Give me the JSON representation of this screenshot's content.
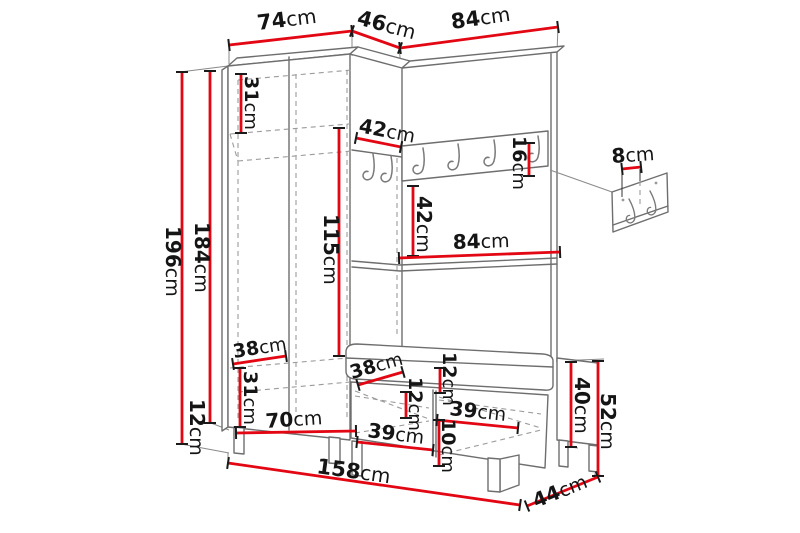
{
  "diagram": {
    "units": "cm",
    "colors": {
      "dimension_red": "#e30613",
      "furniture_gray": "#6e6e6e",
      "hidden_edge_gray": "#9b9b9b",
      "text": "#151515",
      "background": "#ffffff"
    },
    "rail_hook_count": 6,
    "wall_panel_hook_count": 2
  },
  "dimensions": [
    {
      "value": "74",
      "unit": "cm",
      "line": [
        229,
        45,
        352,
        31
      ],
      "label": [
        258,
        30,
        -7,
        21
      ]
    },
    {
      "value": "46",
      "unit": "cm",
      "line": [
        352,
        31,
        400,
        48
      ],
      "label": [
        356,
        24,
        15,
        21
      ]
    },
    {
      "value": "84",
      "unit": "cm",
      "line": [
        400,
        48,
        558,
        27
      ],
      "label": [
        452,
        29,
        -8,
        21
      ]
    },
    {
      "value": "196",
      "unit": "cm",
      "line": [
        182,
        72,
        182,
        444
      ],
      "label": [
        166,
        226,
        90,
        20
      ]
    },
    {
      "value": "184",
      "unit": "cm",
      "line": [
        210,
        71,
        210,
        423
      ],
      "label": [
        195,
        222,
        90,
        20
      ]
    },
    {
      "value": "12",
      "unit": "cm",
      "line": null,
      "label": [
        190,
        399,
        90,
        20
      ]
    },
    {
      "value": "31",
      "unit": "cm",
      "line": [
        241,
        74,
        241,
        133
      ],
      "label": [
        245,
        76,
        90,
        19
      ]
    },
    {
      "value": "115",
      "unit": "cm",
      "line": [
        339,
        128,
        339,
        356
      ],
      "label": [
        324,
        214,
        90,
        20
      ]
    },
    {
      "value": "38",
      "unit": "cm",
      "line": [
        233,
        364,
        286,
        356
      ],
      "label": [
        234,
        358,
        -9,
        19
      ]
    },
    {
      "value": "31",
      "unit": "cm",
      "line": [
        240,
        368,
        240,
        427
      ],
      "label": [
        244,
        371,
        90,
        19
      ]
    },
    {
      "value": "70",
      "unit": "cm",
      "line": [
        236,
        433,
        356,
        431
      ],
      "label": [
        266,
        428,
        -4,
        20
      ]
    },
    {
      "value": "42",
      "unit": "cm",
      "line": [
        356,
        138,
        401,
        147
      ],
      "label": [
        358,
        132,
        11,
        20
      ]
    },
    {
      "value": "16",
      "unit": "cm",
      "line": [
        529,
        143,
        529,
        176
      ],
      "label": [
        513,
        136,
        90,
        19
      ]
    },
    {
      "value": "42",
      "unit": "cm",
      "line": [
        413,
        186,
        413,
        256
      ],
      "label": [
        417,
        196,
        90,
        20
      ]
    },
    {
      "value": "84",
      "unit": "cm",
      "line": [
        399,
        258,
        560,
        252
      ],
      "label": [
        453,
        249,
        -2,
        20
      ]
    },
    {
      "value": "8",
      "unit": "cm",
      "line": [
        622,
        169,
        641,
        167
      ],
      "label": [
        612,
        163,
        -4,
        20
      ]
    },
    {
      "value": "38",
      "unit": "cm",
      "line": [
        358,
        385,
        403,
        372
      ],
      "label": [
        352,
        379,
        -16,
        19
      ]
    },
    {
      "value": "12",
      "unit": "cm",
      "line": [
        406,
        392,
        406,
        418
      ],
      "label": [
        409,
        377,
        90,
        19
      ]
    },
    {
      "value": "12",
      "unit": "cm",
      "line": [
        440,
        368,
        440,
        393
      ],
      "label": [
        443,
        352,
        90,
        19
      ]
    },
    {
      "value": "39",
      "unit": "cm",
      "line": [
        357,
        442,
        433,
        450
      ],
      "label": [
        367,
        437,
        7,
        20
      ]
    },
    {
      "value": "39",
      "unit": "cm",
      "line": [
        437,
        420,
        518,
        428
      ],
      "label": [
        449,
        415,
        6,
        20
      ]
    },
    {
      "value": "10",
      "unit": "cm",
      "line": [
        439,
        420,
        439,
        466
      ],
      "label": [
        442,
        419,
        90,
        19
      ]
    },
    {
      "value": "40",
      "unit": "cm",
      "line": [
        571,
        362,
        571,
        447
      ],
      "label": [
        575,
        377,
        90,
        20
      ]
    },
    {
      "value": "52",
      "unit": "cm",
      "line": [
        598,
        361,
        598,
        476
      ],
      "label": [
        601,
        393,
        90,
        20
      ]
    },
    {
      "value": "44",
      "unit": "cm",
      "line": [
        527,
        506,
        598,
        477
      ],
      "label": [
        536,
        508,
        -22,
        20
      ]
    },
    {
      "value": "158",
      "unit": "cm",
      "line": [
        228,
        463,
        520,
        505
      ],
      "label": [
        316,
        473,
        8,
        21
      ]
    }
  ]
}
